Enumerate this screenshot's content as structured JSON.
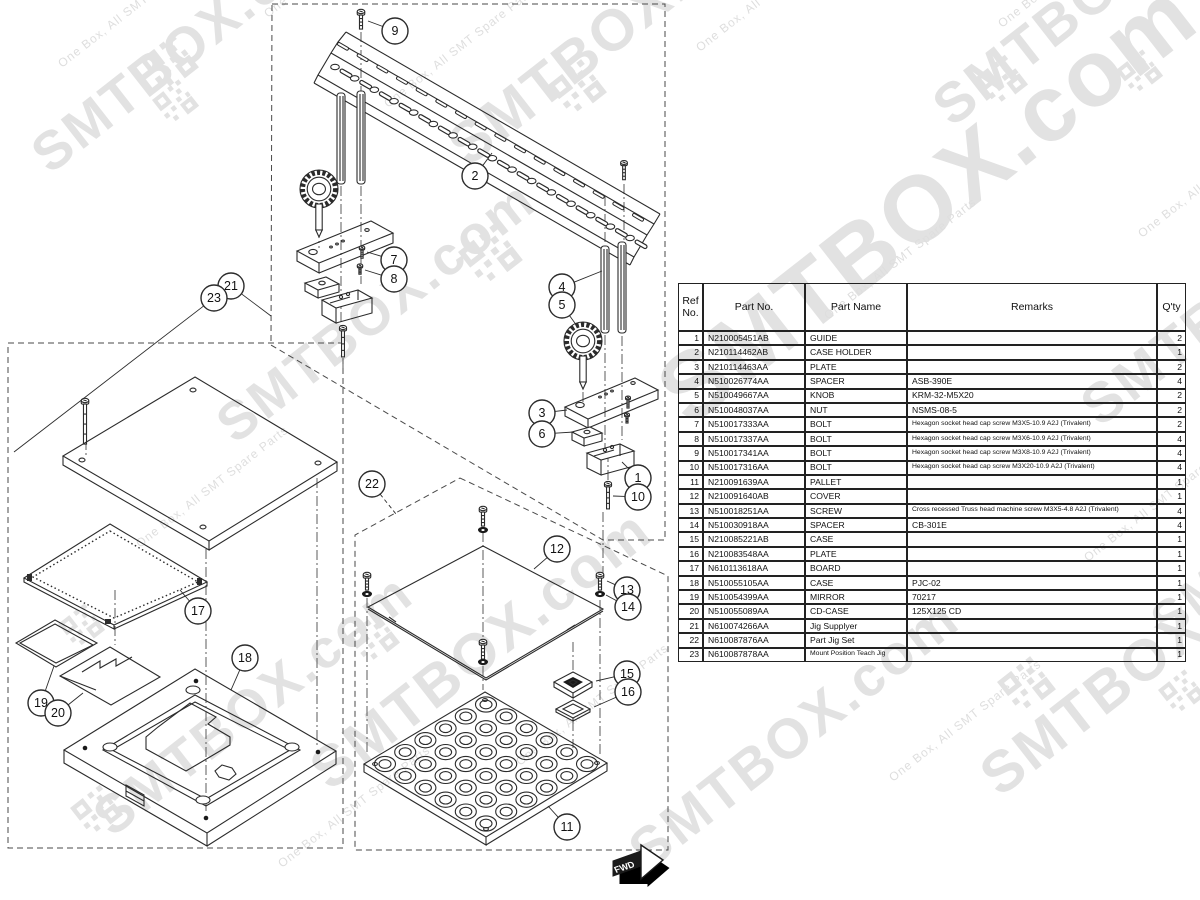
{
  "table": {
    "headers": [
      "Ref\nNo.",
      "Part No.",
      "Part Name",
      "Remarks",
      "Q'ty"
    ],
    "rows": [
      {
        "ref": "1",
        "part_no": "N210005451AB",
        "part_name": "GUIDE",
        "remarks": "",
        "qty": "2"
      },
      {
        "ref": "2",
        "part_no": "N210114462AB",
        "part_name": "CASE HOLDER",
        "remarks": "",
        "qty": "1"
      },
      {
        "ref": "3",
        "part_no": "N210114463AA",
        "part_name": "PLATE",
        "remarks": "",
        "qty": "2"
      },
      {
        "ref": "4",
        "part_no": "N510026774AA",
        "part_name": "SPACER",
        "remarks": "ASB-390E",
        "qty": "4"
      },
      {
        "ref": "5",
        "part_no": "N510049667AA",
        "part_name": "KNOB",
        "remarks": "KRM-32-M5X20",
        "qty": "2"
      },
      {
        "ref": "6",
        "part_no": "N510048037AA",
        "part_name": "NUT",
        "remarks": "NSMS-08-5",
        "qty": "2"
      },
      {
        "ref": "7",
        "part_no": "N510017333AA",
        "part_name": "BOLT",
        "remarks": "Hexagon socket head cap screw M3X5-10.9 A2J (Trivalent)",
        "qty": "2"
      },
      {
        "ref": "8",
        "part_no": "N510017337AA",
        "part_name": "BOLT",
        "remarks": "Hexagon socket head cap screw M3X6-10.9 A2J (Trivalent)",
        "qty": "4"
      },
      {
        "ref": "9",
        "part_no": "N510017341AA",
        "part_name": "BOLT",
        "remarks": "Hexagon socket head cap screw M3X8-10.9 A2J (Trivalent)",
        "qty": "4"
      },
      {
        "ref": "10",
        "part_no": "N510017316AA",
        "part_name": "BOLT",
        "remarks": "Hexagon socket head cap screw M3X20-10.9 A2J (Trivalent)",
        "qty": "4"
      },
      {
        "ref": "11",
        "part_no": "N210091639AA",
        "part_name": "PALLET",
        "remarks": "",
        "qty": "1"
      },
      {
        "ref": "12",
        "part_no": "N210091640AB",
        "part_name": "COVER",
        "remarks": "",
        "qty": "1"
      },
      {
        "ref": "13",
        "part_no": "N510018251AA",
        "part_name": "SCREW",
        "remarks": "Cross recessed Truss head machine screw M3X5-4.8 A2J (Trivalent)",
        "qty": "4"
      },
      {
        "ref": "14",
        "part_no": "N510030918AA",
        "part_name": "SPACER",
        "remarks": "CB-301E",
        "qty": "4"
      },
      {
        "ref": "15",
        "part_no": "N210085221AB",
        "part_name": "CASE",
        "remarks": "",
        "qty": "1"
      },
      {
        "ref": "16",
        "part_no": "N210083548AA",
        "part_name": "PLATE",
        "remarks": "",
        "qty": "1"
      },
      {
        "ref": "17",
        "part_no": "N610113618AA",
        "part_name": "BOARD",
        "remarks": "",
        "qty": "1"
      },
      {
        "ref": "18",
        "part_no": "N510055105AA",
        "part_name": "CASE",
        "remarks": "PJC-02",
        "qty": "1"
      },
      {
        "ref": "19",
        "part_no": "N510054399AA",
        "part_name": "MIRROR",
        "remarks": "70217",
        "qty": "1"
      },
      {
        "ref": "20",
        "part_no": "N510055089AA",
        "part_name": "CD-CASE",
        "remarks": "125X125 CD",
        "qty": "1"
      },
      {
        "ref": "21",
        "part_no": "N610074266AA",
        "part_name": "Jig Supplyer",
        "remarks": "",
        "qty": "1"
      },
      {
        "ref": "22",
        "part_no": "N610087876AA",
        "part_name": "Part Jig Set",
        "remarks": "",
        "qty": "1"
      },
      {
        "ref": "23",
        "part_no": "N610087878AA",
        "part_name": "Mount Position Teach Jig",
        "remarks": "",
        "qty": "1"
      }
    ]
  },
  "callouts": [
    {
      "n": "9",
      "x": 395,
      "y": 31,
      "tx": 368,
      "ty": 21
    },
    {
      "n": "2",
      "x": 475,
      "y": 176,
      "tx": 492,
      "ty": 153
    },
    {
      "n": "7",
      "x": 394,
      "y": 260,
      "tx": 367,
      "ty": 252
    },
    {
      "n": "8",
      "x": 394,
      "y": 279,
      "tx": 365,
      "ty": 270
    },
    {
      "n": "21",
      "x": 231,
      "y": 286,
      "tx": 271,
      "ty": 316
    },
    {
      "n": "23",
      "x": 214,
      "y": 298,
      "tx": 14,
      "ty": 452
    },
    {
      "n": "4",
      "x": 562,
      "y": 287,
      "tx": 602,
      "ty": 271
    },
    {
      "n": "5",
      "x": 562,
      "y": 305,
      "tx": 577,
      "ty": 326
    },
    {
      "n": "3",
      "x": 542,
      "y": 413,
      "tx": 567,
      "ty": 410
    },
    {
      "n": "6",
      "x": 542,
      "y": 434,
      "tx": 574,
      "ty": 432
    },
    {
      "n": "1",
      "x": 638,
      "y": 478,
      "tx": 622,
      "ty": 462
    },
    {
      "n": "10",
      "x": 638,
      "y": 497,
      "tx": 613,
      "ty": 496
    },
    {
      "n": "17",
      "x": 198,
      "y": 611,
      "tx": 180,
      "ty": 590
    },
    {
      "n": "19",
      "x": 41,
      "y": 703,
      "tx": 54,
      "ty": 666
    },
    {
      "n": "20",
      "x": 58,
      "y": 713,
      "tx": 83,
      "ty": 693
    },
    {
      "n": "18",
      "x": 245,
      "y": 658,
      "tx": 231,
      "ty": 690
    },
    {
      "n": "22",
      "x": 372,
      "y": 484,
      "tx": 396,
      "ty": 514,
      "dashed": true
    },
    {
      "n": "12",
      "x": 557,
      "y": 549,
      "tx": 534,
      "ty": 569
    },
    {
      "n": "13",
      "x": 627,
      "y": 590,
      "tx": 607,
      "ty": 581
    },
    {
      "n": "14",
      "x": 628,
      "y": 607,
      "tx": 606,
      "ty": 595
    },
    {
      "n": "15",
      "x": 627,
      "y": 674,
      "tx": 596,
      "ty": 681
    },
    {
      "n": "16",
      "x": 628,
      "y": 692,
      "tx": 594,
      "ty": 707
    },
    {
      "n": "11",
      "x": 567,
      "y": 827,
      "tx": 548,
      "ty": 806
    }
  ],
  "watermark": {
    "big_text": "SMTBOX.com",
    "small_text": "One Box, All SMT Spare Parts",
    "rotation": -38,
    "big_color": "#e2e2e2",
    "small_color": "#dedede",
    "big_positions": [
      {
        "x": 50,
        "y": 175,
        "s": 54
      },
      {
        "x": 235,
        "y": 445,
        "s": 54
      },
      {
        "x": 468,
        "y": 168,
        "s": 58
      },
      {
        "x": 690,
        "y": 428,
        "s": 94
      },
      {
        "x": 952,
        "y": 128,
        "s": 56
      },
      {
        "x": 1100,
        "y": 428,
        "s": 56
      },
      {
        "x": 1000,
        "y": 798,
        "s": 58
      },
      {
        "x": 112,
        "y": 838,
        "s": 54
      },
      {
        "x": 648,
        "y": 872,
        "s": 56
      },
      {
        "x": 330,
        "y": 792,
        "s": 58
      },
      {
        "x": 1168,
        "y": 640,
        "s": 50
      }
    ],
    "small_positions": [
      {
        "x": 62,
        "y": 68
      },
      {
        "x": 268,
        "y": 18
      },
      {
        "x": 700,
        "y": 52
      },
      {
        "x": 1002,
        "y": 28
      },
      {
        "x": 140,
        "y": 548
      },
      {
        "x": 388,
        "y": 108
      },
      {
        "x": 828,
        "y": 320
      },
      {
        "x": 893,
        "y": 782
      },
      {
        "x": 520,
        "y": 766
      },
      {
        "x": 1088,
        "y": 562
      },
      {
        "x": 282,
        "y": 868
      },
      {
        "x": 1142,
        "y": 238
      }
    ],
    "qr_positions": [
      {
        "x": 140,
        "y": 60,
        "s": 1
      },
      {
        "x": 152,
        "y": 100,
        "s": 0.8
      },
      {
        "x": 548,
        "y": 85,
        "s": 1
      },
      {
        "x": 458,
        "y": 252,
        "s": 1.1
      },
      {
        "x": 975,
        "y": 78,
        "s": 0.9
      },
      {
        "x": 1116,
        "y": 70,
        "s": 0.8
      },
      {
        "x": 997,
        "y": 682,
        "s": 1
      },
      {
        "x": 58,
        "y": 624,
        "s": 0.8
      },
      {
        "x": 70,
        "y": 808,
        "s": 0.9
      },
      {
        "x": 347,
        "y": 636,
        "s": 0.9
      },
      {
        "x": 1158,
        "y": 690,
        "s": 0.8
      }
    ]
  },
  "fwd_label": "FWD"
}
